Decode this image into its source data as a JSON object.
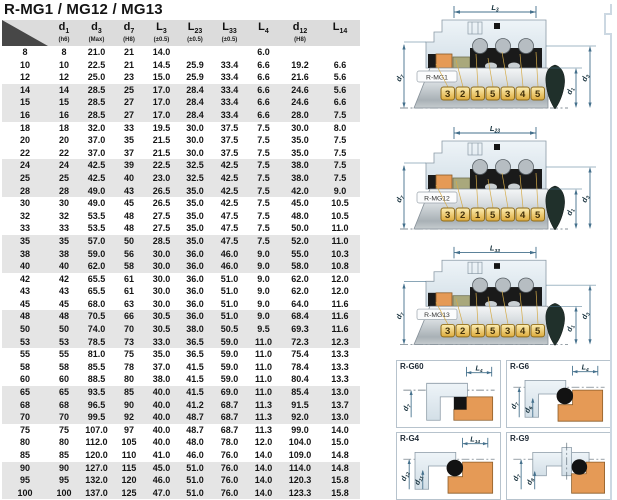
{
  "title": "R-MG1 / MG12 / MG13",
  "table": {
    "headers": [
      {
        "sym": "",
        "sub": "",
        "note": ""
      },
      {
        "sym": "d",
        "sub": "1",
        "note": "(h6)"
      },
      {
        "sym": "d",
        "sub": "3",
        "note": "(Max)"
      },
      {
        "sym": "d",
        "sub": "7",
        "note": "(H8)"
      },
      {
        "sym": "L",
        "sub": "3",
        "note": "(±0.5)"
      },
      {
        "sym": "L",
        "sub": "23",
        "note": "(±0.5)"
      },
      {
        "sym": "L",
        "sub": "33",
        "note": "(±0.5)"
      },
      {
        "sym": "L",
        "sub": "4",
        "note": ""
      },
      {
        "sym": "d",
        "sub": "12",
        "note": "(H8)"
      },
      {
        "sym": "L",
        "sub": "14",
        "note": ""
      }
    ],
    "rows": [
      [
        "8",
        "8",
        "21.0",
        "21",
        "14.0",
        "",
        "",
        "6.0",
        "",
        ""
      ],
      [
        "10",
        "10",
        "22.5",
        "21",
        "14.5",
        "25.9",
        "33.4",
        "6.6",
        "19.2",
        "6.6"
      ],
      [
        "12",
        "12",
        "25.0",
        "23",
        "15.0",
        "25.9",
        "33.4",
        "6.6",
        "21.6",
        "5.6"
      ],
      [
        "14",
        "14",
        "28.5",
        "25",
        "17.0",
        "28.4",
        "33.4",
        "6.6",
        "24.6",
        "5.6"
      ],
      [
        "15",
        "15",
        "28.5",
        "27",
        "17.0",
        "28.4",
        "33.4",
        "6.6",
        "24.6",
        "6.6"
      ],
      [
        "16",
        "16",
        "28.5",
        "27",
        "17.0",
        "28.4",
        "33.4",
        "6.6",
        "28.0",
        "7.5"
      ],
      [
        "18",
        "18",
        "32.0",
        "33",
        "19.5",
        "30.0",
        "37.5",
        "7.5",
        "30.0",
        "8.0"
      ],
      [
        "20",
        "20",
        "37.0",
        "35",
        "21.5",
        "30.0",
        "37.5",
        "7.5",
        "35.0",
        "7.5"
      ],
      [
        "22",
        "22",
        "37.0",
        "37",
        "21.5",
        "30.0",
        "37.5",
        "7.5",
        "35.0",
        "7.5"
      ],
      [
        "24",
        "24",
        "42.5",
        "39",
        "22.5",
        "32.5",
        "42.5",
        "7.5",
        "38.0",
        "7.5"
      ],
      [
        "25",
        "25",
        "42.5",
        "40",
        "23.0",
        "32.5",
        "42.5",
        "7.5",
        "38.0",
        "7.5"
      ],
      [
        "28",
        "28",
        "49.0",
        "43",
        "26.5",
        "35.0",
        "42.5",
        "7.5",
        "42.0",
        "9.0"
      ],
      [
        "30",
        "30",
        "49.0",
        "45",
        "26.5",
        "35.0",
        "42.5",
        "7.5",
        "45.0",
        "10.5"
      ],
      [
        "32",
        "32",
        "53.5",
        "48",
        "27.5",
        "35.0",
        "47.5",
        "7.5",
        "48.0",
        "10.5"
      ],
      [
        "33",
        "33",
        "53.5",
        "48",
        "27.5",
        "35.0",
        "47.5",
        "7.5",
        "50.0",
        "11.0"
      ],
      [
        "35",
        "35",
        "57.0",
        "50",
        "28.5",
        "35.0",
        "47.5",
        "7.5",
        "52.0",
        "11.0"
      ],
      [
        "38",
        "38",
        "59.0",
        "56",
        "30.0",
        "36.0",
        "46.0",
        "9.0",
        "55.0",
        "10.3"
      ],
      [
        "40",
        "40",
        "62.0",
        "58",
        "30.0",
        "36.0",
        "46.0",
        "9.0",
        "58.0",
        "10.8"
      ],
      [
        "42",
        "42",
        "65.5",
        "61",
        "30.0",
        "36.0",
        "51.0",
        "9.0",
        "62.0",
        "12.0"
      ],
      [
        "43",
        "43",
        "65.5",
        "61",
        "30.0",
        "36.0",
        "51.0",
        "9.0",
        "62.0",
        "12.0"
      ],
      [
        "45",
        "45",
        "68.0",
        "63",
        "30.0",
        "36.0",
        "51.0",
        "9.0",
        "64.0",
        "11.6"
      ],
      [
        "48",
        "48",
        "70.5",
        "66",
        "30.5",
        "36.0",
        "51.0",
        "9.0",
        "68.4",
        "11.6"
      ],
      [
        "50",
        "50",
        "74.0",
        "70",
        "30.5",
        "38.0",
        "50.5",
        "9.5",
        "69.3",
        "11.6"
      ],
      [
        "53",
        "53",
        "78.5",
        "73",
        "33.0",
        "36.5",
        "59.0",
        "11.0",
        "72.3",
        "12.3"
      ],
      [
        "55",
        "55",
        "81.0",
        "75",
        "35.0",
        "36.5",
        "59.0",
        "11.0",
        "75.4",
        "13.3"
      ],
      [
        "58",
        "58",
        "85.5",
        "78",
        "37.0",
        "41.5",
        "59.0",
        "11.0",
        "78.4",
        "13.3"
      ],
      [
        "60",
        "60",
        "88.5",
        "80",
        "38.0",
        "41.5",
        "59.0",
        "11.0",
        "80.4",
        "13.3"
      ],
      [
        "65",
        "65",
        "93.5",
        "85",
        "40.0",
        "41.5",
        "69.0",
        "11.0",
        "85.4",
        "13.0"
      ],
      [
        "68",
        "68",
        "96.5",
        "90",
        "40.0",
        "41.2",
        "68.7",
        "11.3",
        "91.5",
        "13.7"
      ],
      [
        "70",
        "70",
        "99.5",
        "92",
        "40.0",
        "48.7",
        "68.7",
        "11.3",
        "92.0",
        "13.0"
      ],
      [
        "75",
        "75",
        "107.0",
        "97",
        "40.0",
        "48.7",
        "68.7",
        "11.3",
        "99.0",
        "14.0"
      ],
      [
        "80",
        "80",
        "112.0",
        "105",
        "40.0",
        "48.0",
        "78.0",
        "12.0",
        "104.0",
        "15.0"
      ],
      [
        "85",
        "85",
        "120.0",
        "110",
        "41.0",
        "46.0",
        "76.0",
        "14.0",
        "109.0",
        "14.8"
      ],
      [
        "90",
        "90",
        "127.0",
        "115",
        "45.0",
        "51.0",
        "76.0",
        "14.0",
        "114.0",
        "14.8"
      ],
      [
        "95",
        "95",
        "132.0",
        "120",
        "46.0",
        "51.0",
        "76.0",
        "14.0",
        "120.3",
        "15.8"
      ],
      [
        "100",
        "100",
        "137.0",
        "125",
        "47.0",
        "51.0",
        "76.0",
        "14.0",
        "123.3",
        "15.8"
      ]
    ]
  },
  "diagrams": {
    "part_numbers": [
      "3",
      "2",
      "1",
      "5",
      "3",
      "4",
      "5"
    ],
    "shared_dims": {
      "inner_diameter": {
        "sym": "d",
        "sub": "1"
      },
      "outer_diameter": {
        "sym": "d",
        "sub": "3"
      },
      "seat_bore": {
        "sym": "d",
        "sub": "7"
      }
    },
    "main": [
      {
        "name": "R-MG1",
        "length_dim": {
          "sym": "L",
          "sub": "3"
        }
      },
      {
        "name": "R-MG12",
        "length_dim": {
          "sym": "L",
          "sub": "23"
        }
      },
      {
        "name": "R-MG13",
        "length_dim": {
          "sym": "L",
          "sub": "33"
        }
      }
    ],
    "seats": [
      {
        "name": "R-G60",
        "top_dim": {
          "sym": "L",
          "sub": "4"
        },
        "left_dims": [
          {
            "sym": "d",
            "sub": "7"
          }
        ]
      },
      {
        "name": "R-G6",
        "top_dim": {
          "sym": "L",
          "sub": "4"
        },
        "left_dims": [
          {
            "sym": "d",
            "sub": "7"
          },
          {
            "sym": "d",
            "sub": "6"
          }
        ]
      },
      {
        "name": "R-G4",
        "top_dim": {
          "sym": "L",
          "sub": "14"
        },
        "left_dims": [
          {
            "sym": "d",
            "sub": "12"
          },
          {
            "sym": "d",
            "sub": "11"
          }
        ]
      },
      {
        "name": "R-G9",
        "left_dims": [
          {
            "sym": "d",
            "sub": "7"
          },
          {
            "sym": "d",
            "sub": "8"
          }
        ]
      }
    ]
  },
  "colors": {
    "header_bg": "#dcdcdc",
    "row_stripe": "#e5e5e5",
    "tag_yellow": "#e8c04a",
    "housing_grey": "#dfe8ee",
    "elastomer_black": "#1a1a1a",
    "orange": "#e59a56",
    "olive": "#a9a87c",
    "shaft_grey": "#c6cccf",
    "dim_line": "#44708c",
    "seal_tip_dark": "#20302b"
  }
}
